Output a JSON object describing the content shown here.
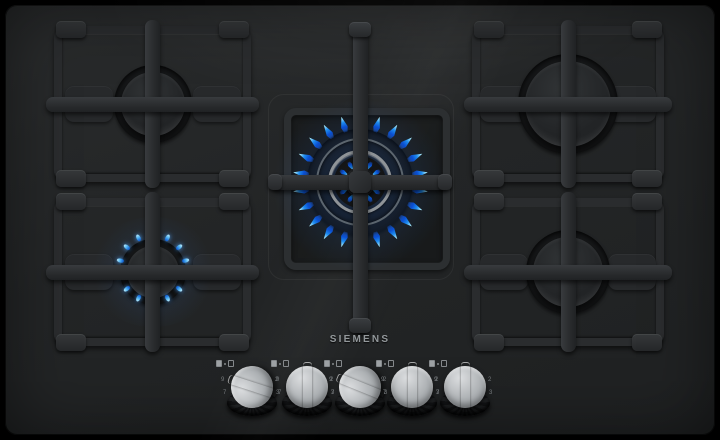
{
  "product": {
    "brand": "SIEMENS",
    "type": "5-burner gas hob",
    "surface": "black glass"
  },
  "brand": {
    "logo": "SIEMENS"
  },
  "colors": {
    "background": "#000000",
    "glass": "#242627",
    "pan_support": "#2c2e30",
    "burner_cap": "#27292b",
    "flame_deep_blue": "#0a4ed2",
    "flame_mid_blue": "#1e8df0",
    "flame_tip_cyan": "#aef0ff",
    "knob_silver": "#c9ccce",
    "logo_gray": "#93989b"
  },
  "burners": {
    "back_left": {
      "label": "back-left burner",
      "size": "medium",
      "state": "off"
    },
    "back_right": {
      "label": "back-right burner",
      "size": "large",
      "state": "off"
    },
    "center": {
      "label": "center dual-ring wok burner",
      "size": "wok",
      "state": "on",
      "level": "high",
      "outer_flame_count": 22,
      "inner_flame_count": 12
    },
    "front_left": {
      "label": "front-left burner",
      "size": "small",
      "state": "on",
      "level": "simmer",
      "flame_count": 14
    },
    "front_right": {
      "label": "front-right burner",
      "size": "medium",
      "state": "off"
    }
  },
  "knobs": [
    {
      "name": "knob-1",
      "controls": "front_left",
      "state": "on",
      "angle_deg": -72
    },
    {
      "name": "knob-2",
      "controls": "back_left",
      "state": "off",
      "angle_deg": 0
    },
    {
      "name": "knob-3",
      "controls": "center",
      "state": "on",
      "angle_deg": -68
    },
    {
      "name": "knob-4",
      "controls": "back_right",
      "state": "off",
      "angle_deg": 0
    },
    {
      "name": "knob-5",
      "controls": "front_right",
      "state": "off",
      "angle_deg": 0
    }
  ],
  "knob_scale": {
    "left_top": "9",
    "left_bottom": "7",
    "right_top": "2",
    "right_bottom": "3"
  }
}
